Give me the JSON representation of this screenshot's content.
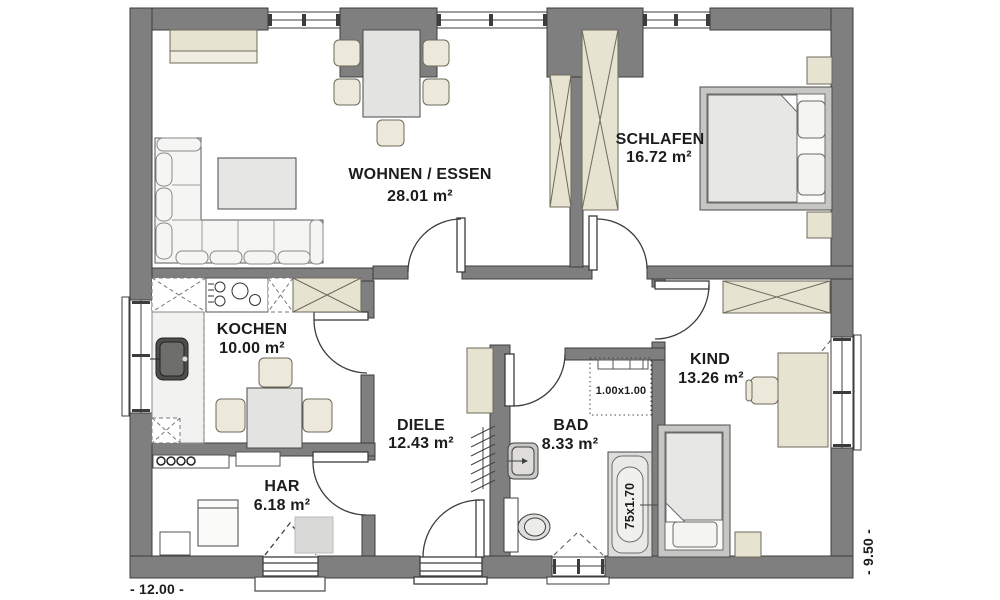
{
  "title": "Bungalow floor plan",
  "colors": {
    "wall": "#7f7f7f",
    "wall_outline": "#3c3c3c",
    "furniture_tan": "#e7e3d1",
    "furniture_gray": "#e3e3e1",
    "sofa_white": "#f5f5f3",
    "bed_frame": "#c6c6c4",
    "sink_dark": "#4e4e4c",
    "text": "#1c1c1c"
  },
  "rooms": {
    "wohnen": {
      "label": "WOHNEN / ESSEN",
      "area": "28.01 m²"
    },
    "schlafen": {
      "label": "SCHLAFEN",
      "area": "16.72 m²"
    },
    "kochen": {
      "label": "KOCHEN",
      "area": "10.00 m²"
    },
    "kind": {
      "label": "KIND",
      "area": "13.26 m²"
    },
    "diele": {
      "label": "DIELE",
      "area": "12.43 m²"
    },
    "bad": {
      "label": "BAD",
      "area": "8.33 m²"
    },
    "har": {
      "label": "HAR",
      "area": "6.18 m²"
    }
  },
  "annotations": {
    "skylight": "1.00x1.00",
    "bathtub": "75x1.70"
  },
  "dimensions": {
    "width": "- 12.00 -",
    "depth": "- 9.50 -"
  }
}
